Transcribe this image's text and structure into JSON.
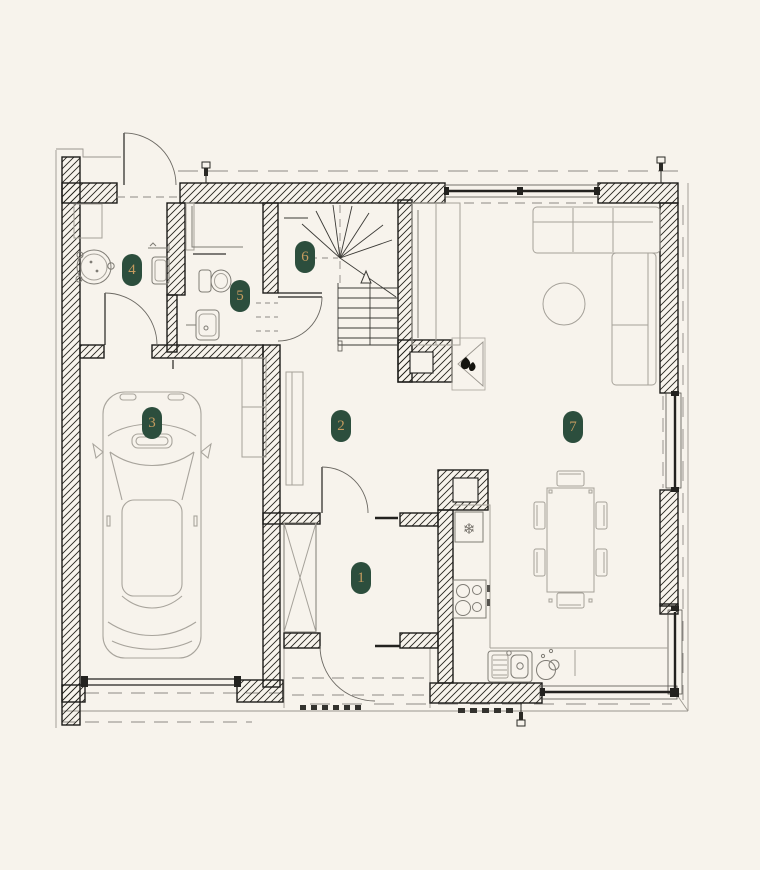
{
  "plan": {
    "colors": {
      "background": "#F7F3EC",
      "badge_bg": "#2C4E3D",
      "badge_text": "#C59B5F",
      "wall_line": "#1D1C1A",
      "furniture_line": "#A5A199"
    },
    "room_badges": [
      {
        "number": "1"
      },
      {
        "number": "2"
      },
      {
        "number": "3"
      },
      {
        "number": "4"
      },
      {
        "number": "5"
      },
      {
        "number": "6"
      },
      {
        "number": "7"
      }
    ],
    "icons": {
      "fridge_snowflake": "❄"
    }
  }
}
